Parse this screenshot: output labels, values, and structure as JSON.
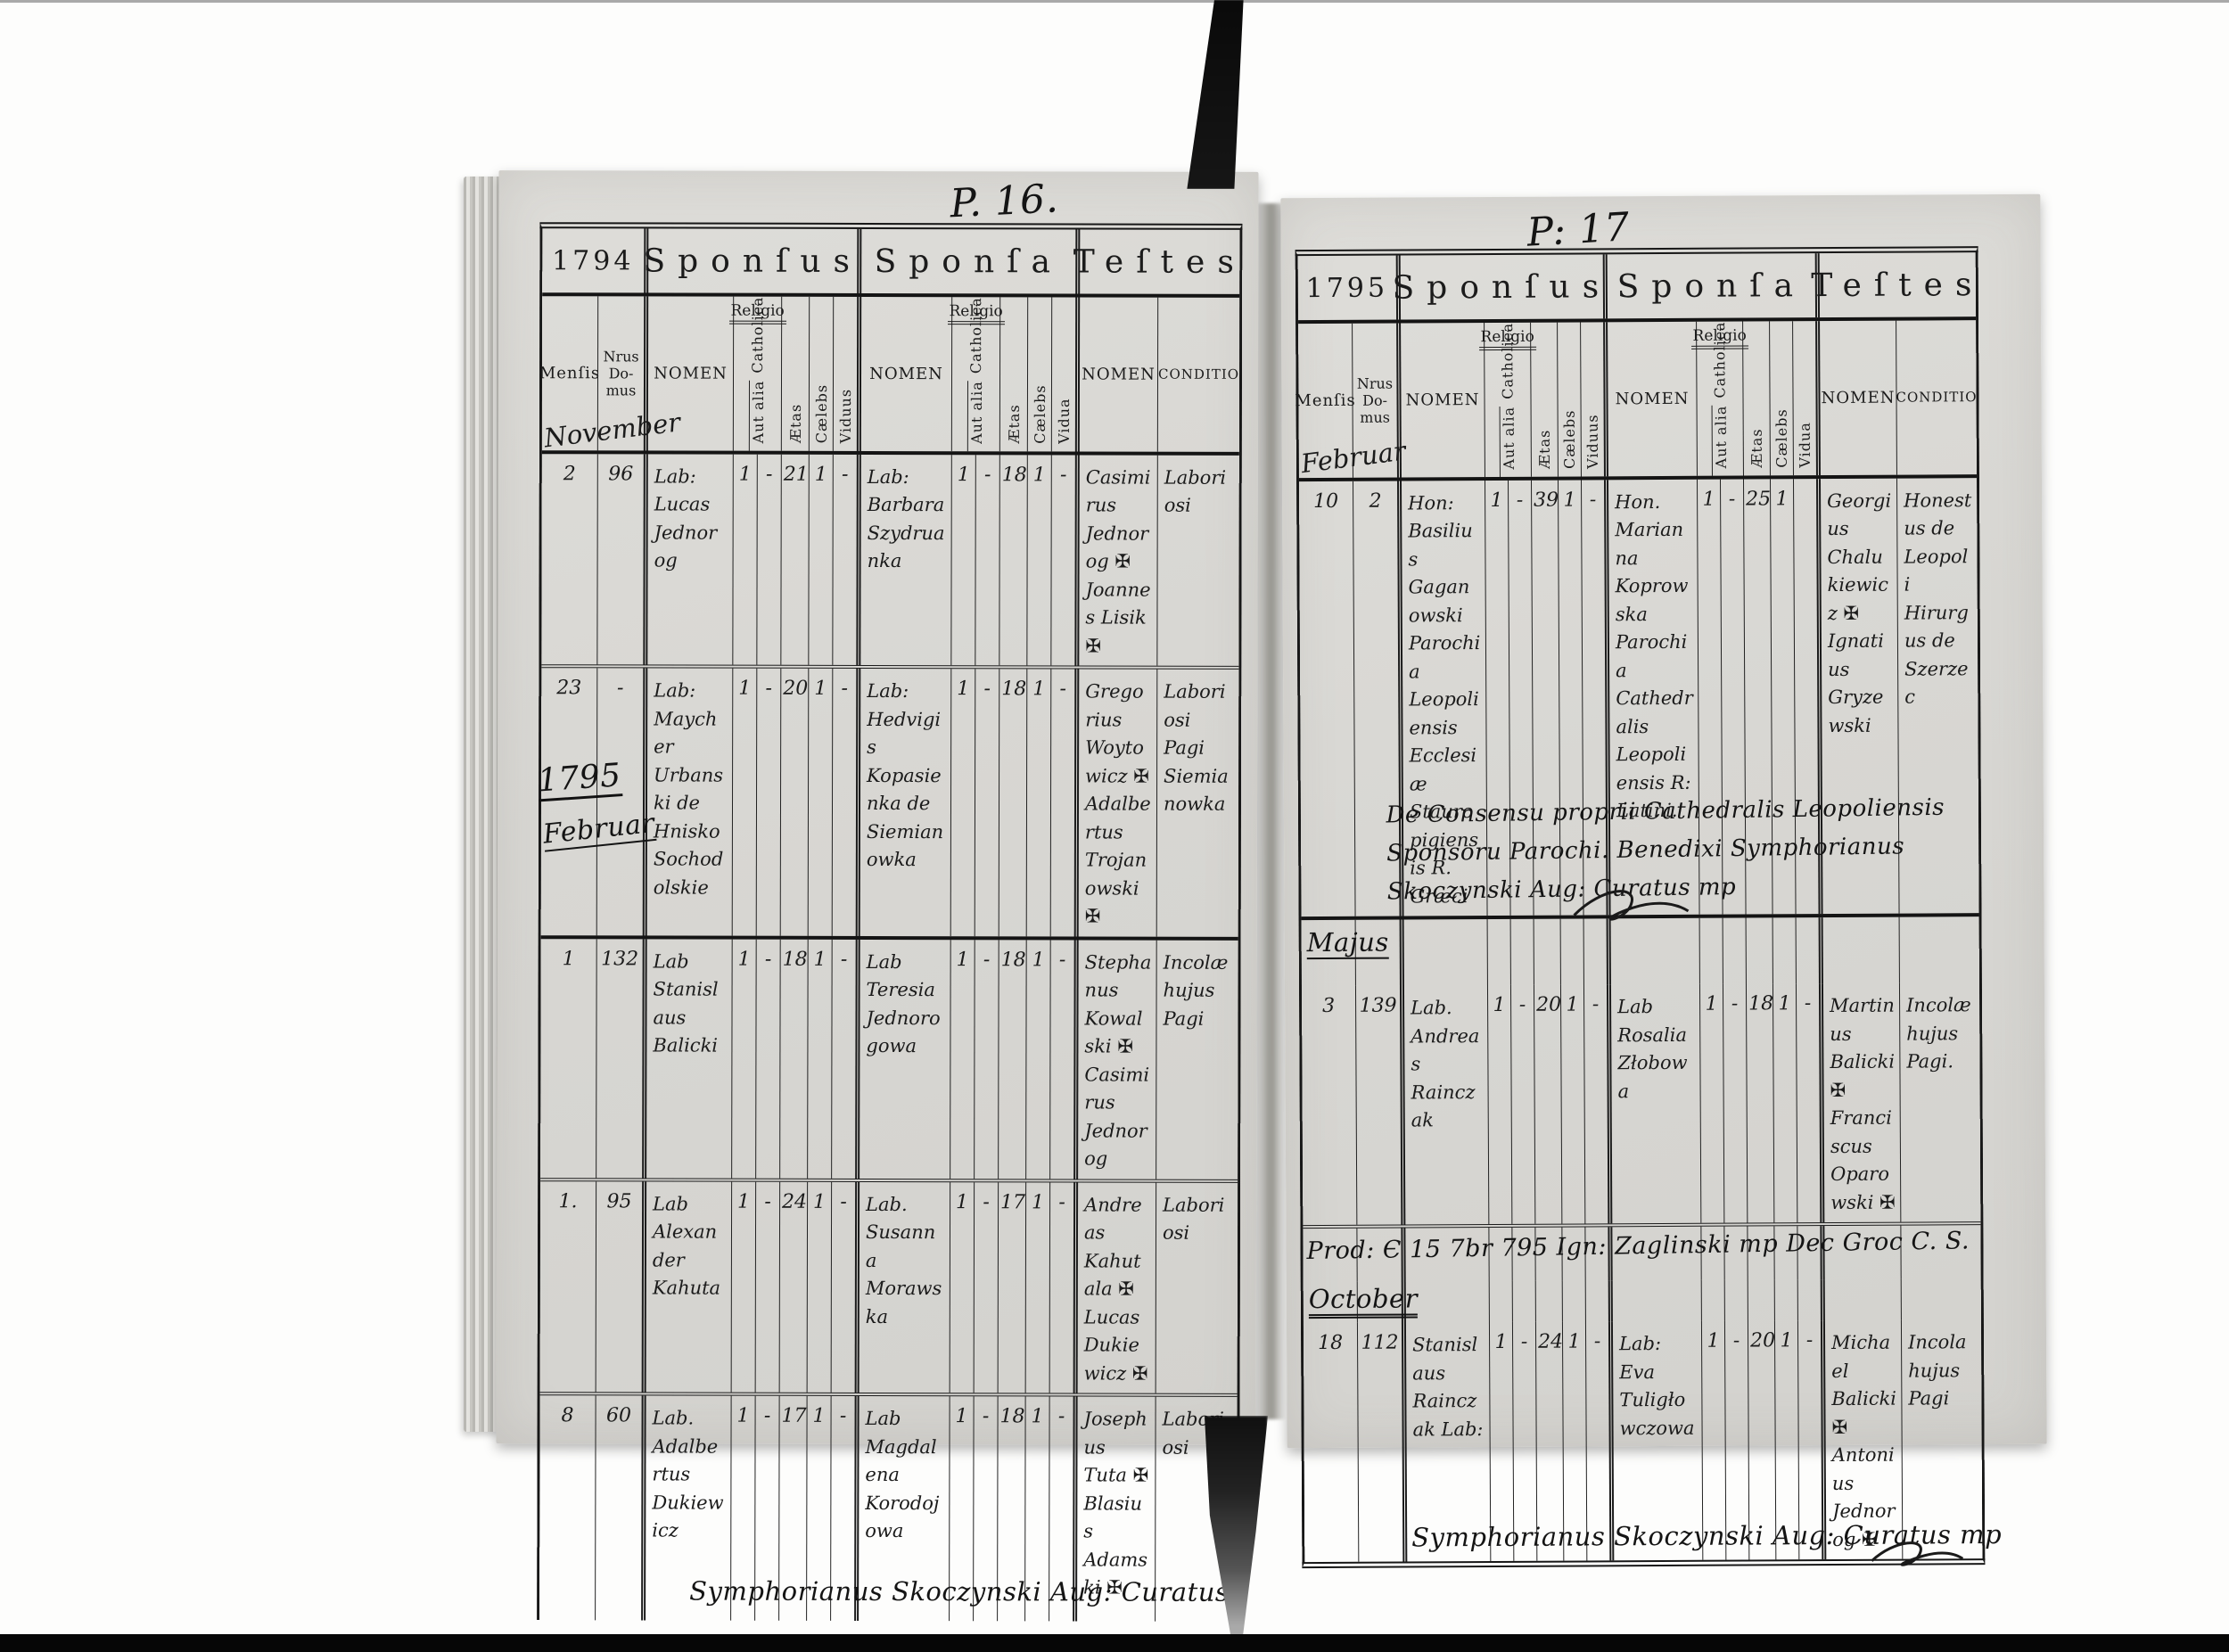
{
  "document_type": "Parish marriage register (Liber copulatorum), two-page scan",
  "colors": {
    "paper": "#d8d7d3",
    "ink": "#1b1b1b",
    "photo_background": "#fdfdfc",
    "ribbon": "#0e0e0e",
    "gutter_shadow": "#9b9a94",
    "bottom_bar": "#060606"
  },
  "sections": {
    "sponsus": "Sponſus",
    "sponsa": "Sponſa",
    "testes": "Teſtes"
  },
  "labels": {
    "mensis": "Menſis",
    "nrus1": "Nrus",
    "nrus2": "Do-",
    "nrus3": "mus",
    "nomen": "NOMEN",
    "religio": "Religio",
    "catholica": "Catholica",
    "aut_alia": "Aut alia",
    "aetas": "Ætas",
    "caelebs": "Cælebs",
    "viduus": "Viduus",
    "vidua": "Vidua",
    "conditio": "CONDITIO"
  },
  "left_page": {
    "page_no": "P. 16.",
    "year": "1794",
    "month1": "November",
    "year_note": "1795",
    "month2": "Februar",
    "rows": [
      {
        "mensis": "2",
        "nrus": "96",
        "sponsus": "Lab: Lucas Jednorog",
        "sc": "1",
        "sa": "-",
        "se": "21",
        "scb": "1",
        "sv": "-",
        "sponsa": "Lab: Barbara Szydruanka",
        "ac": "1",
        "aa": "-",
        "ae": "18",
        "acb": "1",
        "av": "-",
        "testes": "Casimirus Jednorog ✠ Joannes Lisik ✠",
        "cond": "Laboriosi"
      },
      {
        "mensis": "23",
        "nrus": "-",
        "sponsus": "Lab: Maycher Urbanski de Hnisko Sochodolskie",
        "sc": "1",
        "sa": "-",
        "se": "20",
        "scb": "1",
        "sv": "-",
        "sponsa": "Lab: Hedvigis Kopasienka de Siemianowka",
        "ac": "1",
        "aa": "-",
        "ae": "18",
        "acb": "1",
        "av": "-",
        "testes": "Gregorius Woytowicz ✠ Adalbertus Trojanowski ✠",
        "cond": "Laboriosi Pagi Siemianowka"
      },
      {
        "mensis": "1",
        "nrus": "132",
        "sponsus": "Lab Stanislaus Balicki",
        "sc": "1",
        "sa": "-",
        "se": "18",
        "scb": "1",
        "sv": "-",
        "sponsa": "Lab Teresia Jednorogowa",
        "ac": "1",
        "aa": "-",
        "ae": "18",
        "acb": "1",
        "av": "-",
        "testes": "Stephanus Kowalski ✠ Casimirus Jednorog",
        "cond": "Incolæ hujus Pagi"
      },
      {
        "mensis": "1.",
        "nrus": "95",
        "sponsus": "Lab Alexander Kahuta",
        "sc": "1",
        "sa": "-",
        "se": "24",
        "scb": "1",
        "sv": "-",
        "sponsa": "Lab. Susanna Morawska",
        "ac": "1",
        "aa": "-",
        "ae": "17",
        "acb": "1",
        "av": "-",
        "testes": "Andreas Kahutala ✠ Lucas Dukiewicz ✠",
        "cond": "Laboriosi"
      },
      {
        "mensis": "8",
        "nrus": "60",
        "sponsus": "Lab. Adalbertus Dukiewicz",
        "sc": "1",
        "sa": "-",
        "se": "17",
        "scb": "1",
        "sv": "-",
        "sponsa": "Lab Magdalena Korodojowa",
        "ac": "1",
        "aa": "-",
        "ae": "18",
        "acb": "1",
        "av": "-",
        "testes": "Josephus Tuta ✠ Blasius Adamski ✠",
        "cond": "Laboriosi"
      }
    ],
    "signature": "Symphorianus Skoczynski Aug: Curatus"
  },
  "right_page": {
    "page_no": "P: 17",
    "year": "1795",
    "month1": "Februar",
    "month2": "Majus",
    "month3": "October",
    "rows": [
      {
        "mensis": "10",
        "nrus": "2",
        "sponsus": "Hon: Basilius Gaganowski Parochia Leopoliensis Ecclesiæ Stauropigiensis R. Græci",
        "sc": "1",
        "sa": "-",
        "se": "39",
        "scb": "1",
        "sv": "-",
        "sponsa": "Hon. Marianna Koprowska Parochia Cathedralis Leopoliensis R: Latini.",
        "ac": "1",
        "aa": "-",
        "ae": "25",
        "acb": "1",
        "av": "",
        "testes": "Georgius Chalukiewicz ✠ Ignatius Gryzewski",
        "cond": "Honestus de Leopoli Hirurgus de Szerzec"
      },
      {
        "mensis": "3",
        "nrus": "139",
        "sponsus": "Lab. Andreas Rainczak",
        "sc": "1",
        "sa": "-",
        "se": "20",
        "scb": "1",
        "sv": "-",
        "sponsa": "Lab Rosalia Złobowa",
        "ac": "1",
        "aa": "-",
        "ae": "18",
        "acb": "1",
        "av": "-",
        "testes": "Martinus Balicki ✠ Franciscus Oparowski ✠",
        "cond": "Incolæ hujus Pagi."
      },
      {
        "mensis": "18",
        "nrus": "112",
        "sponsus": "Stanislaus Rainczak Lab:",
        "sc": "1",
        "sa": "-",
        "se": "24",
        "scb": "1",
        "sv": "-",
        "sponsa": "Lab: Eva Tuligłowczowa",
        "ac": "1",
        "aa": "-",
        "ae": "20",
        "acb": "1",
        "av": "-",
        "testes": "Michael Balicki ✠ Antonius Jednorog ✠",
        "cond": "Incola hujus Pagi"
      }
    ],
    "note1": "De Consensu proprii Cathedralis Leopoliensis Sponsoru Parochi. Benedixi Symphorianus Skoczynski Aug: Curatus mp",
    "note2": "Prod: Є 15 7br 795 Ign: Zaglinski mp Dec Groc C. S.",
    "signature": "Symphorianus Skoczynski Aug: Curatus mp"
  }
}
